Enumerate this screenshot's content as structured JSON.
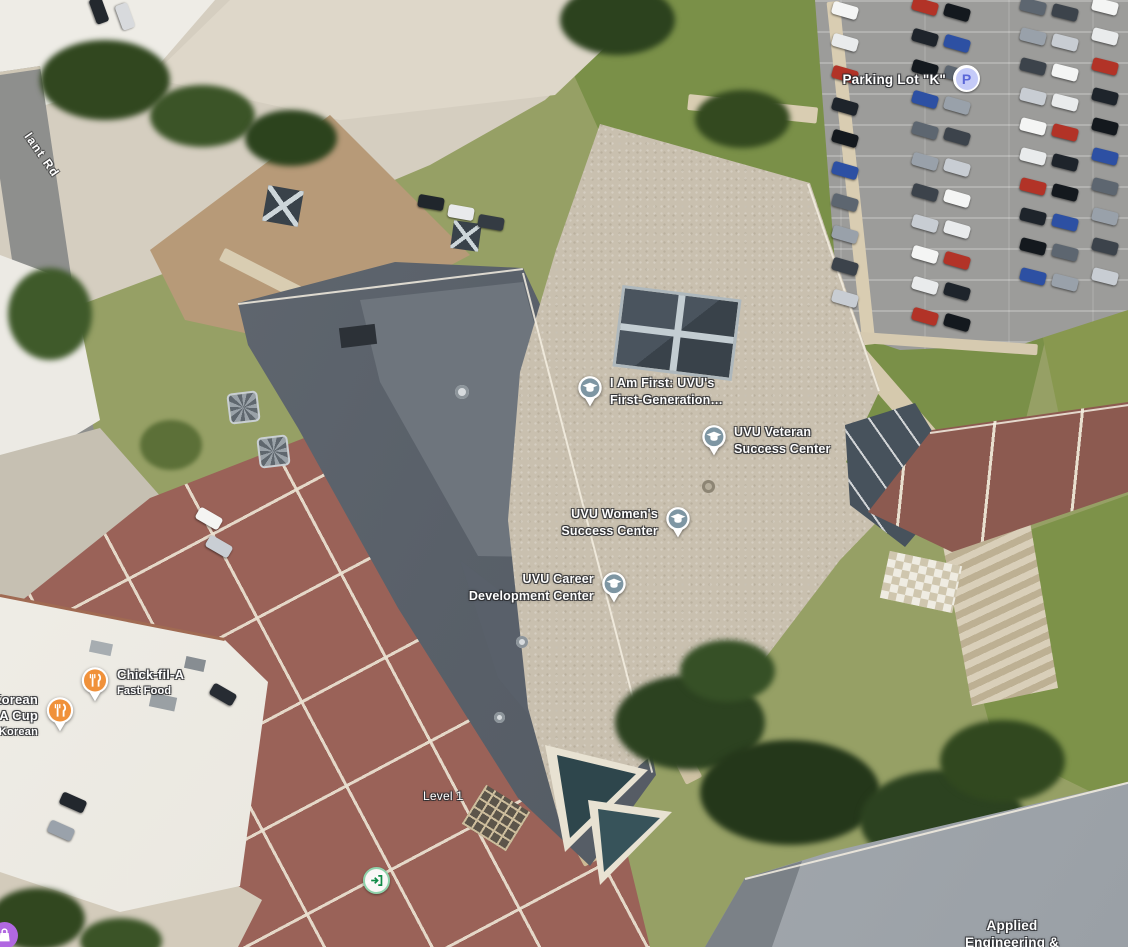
{
  "map_type": "satellite",
  "street": {
    "name_partial": "lant Rd"
  },
  "pois": {
    "parking_k": {
      "name": "Parking Lot \"K\"",
      "icon": "parking-icon",
      "icon_letter": "P"
    },
    "i_am_first": {
      "line1": "I Am First: UVU's",
      "line2": "First-Generation…",
      "icon": "school-pin-icon"
    },
    "veteran": {
      "line1": "UVU Veteran",
      "line2": "Success Center",
      "icon": "school-pin-icon"
    },
    "womens": {
      "line1": "UVU Women's",
      "line2": "Success Center",
      "icon": "school-pin-icon"
    },
    "career": {
      "line1": "UVU Career",
      "line2": "Development Center",
      "icon": "school-pin-icon"
    },
    "chick_fil_a": {
      "name": "Chick-fil-A",
      "subtitle": "Fast Food",
      "icon": "restaurant-pin-icon"
    },
    "korean_a_cup": {
      "line1": "Korean",
      "line2": "A Cup",
      "subtitle": "Korean",
      "icon": "restaurant-pin-icon"
    },
    "applied_eng": {
      "line1": "Applied",
      "line2": "Engineering &"
    },
    "level": {
      "name": "Level 1"
    }
  },
  "colors": {
    "school_pin": "#7e96a3",
    "restaurant_pin": "#f0913a",
    "parking_badge_bg": "#c5cbf8",
    "parking_badge_glyph": "#5b67d8",
    "entrance_ring": "#8fd3ab",
    "entrance_glyph": "#0f8a46",
    "purple_poi": "#b168e1",
    "label_text": "#ffffff"
  },
  "parking_lot": {
    "car_palette": [
      "#f4f5f4",
      "#1e242b",
      "#5d6670",
      "#c8cdd3",
      "#b23327",
      "#2d50a3",
      "#3c434b",
      "#e9ebec",
      "#14191e",
      "#99a1aa"
    ],
    "rows": [
      {
        "x": 832,
        "y": 4,
        "count": 10,
        "gap": 32,
        "angle": 16
      },
      {
        "x": 912,
        "y": 0,
        "count": 11,
        "gap": 31,
        "angle": 16
      },
      {
        "x": 944,
        "y": 6,
        "count": 11,
        "gap": 31,
        "angle": 16
      },
      {
        "x": 1020,
        "y": 0,
        "count": 10,
        "gap": 30,
        "angle": 14
      },
      {
        "x": 1052,
        "y": 6,
        "count": 10,
        "gap": 30,
        "angle": 14
      },
      {
        "x": 1092,
        "y": 0,
        "count": 10,
        "gap": 30,
        "angle": 14
      }
    ],
    "extra_cars": [
      {
        "x": 196,
        "y": 512,
        "angle": 30,
        "color": "#f4f4f2"
      },
      {
        "x": 206,
        "y": 540,
        "angle": 30,
        "color": "#c9ced4"
      },
      {
        "x": 418,
        "y": 196,
        "angle": 10,
        "color": "#20262c"
      },
      {
        "x": 448,
        "y": 206,
        "angle": 10,
        "color": "#e9eaec"
      },
      {
        "x": 478,
        "y": 216,
        "angle": 10,
        "color": "#343b43"
      },
      {
        "x": 60,
        "y": 796,
        "angle": 24,
        "color": "#22272d"
      },
      {
        "x": 48,
        "y": 824,
        "angle": 24,
        "color": "#9aa2ab"
      },
      {
        "x": 86,
        "y": 4,
        "angle": 70,
        "color": "#23282e"
      },
      {
        "x": 112,
        "y": 10,
        "angle": 70,
        "color": "#d8dadd"
      },
      {
        "x": 210,
        "y": 688,
        "angle": 30,
        "color": "#272c33"
      }
    ]
  }
}
